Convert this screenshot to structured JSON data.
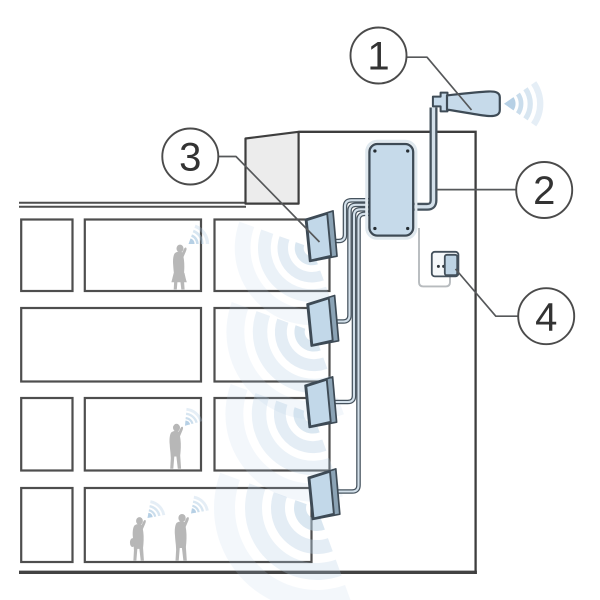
{
  "diagram": {
    "callouts": [
      {
        "label": "1",
        "target": "outdoor-antenna"
      },
      {
        "label": "2",
        "target": "signal-booster"
      },
      {
        "label": "3",
        "target": "indoor-antenna"
      },
      {
        "label": "4",
        "target": "power-outlet"
      }
    ],
    "colors": {
      "device_fill": "#c6daea",
      "device_stroke": "#3e4b56",
      "wave": "#b5cfe4",
      "phone_wave": "#a9c8e0",
      "line": "#4e4e4e",
      "person": "#b7b7b7",
      "roof_structure": "#ececec",
      "power_cable": "#b7bbbe",
      "background": "#ffffff"
    }
  }
}
